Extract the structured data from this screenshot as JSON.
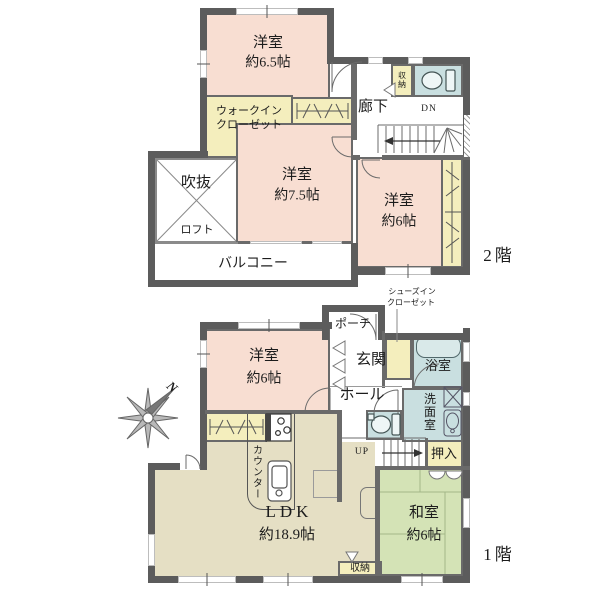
{
  "title": "2階建て住宅間取り図",
  "f2": {
    "floor_label": "2階",
    "room65": {
      "name": "洋室",
      "area": "約6.5帖"
    },
    "wic": {
      "line1": "ウォークイン",
      "line2": "クローゼット"
    },
    "corridor": "廊下",
    "down": "DN",
    "storage": "収納",
    "void": "吹抜",
    "loft": "ロフト",
    "room75": {
      "name": "洋室",
      "area": "約7.5帖"
    },
    "room6": {
      "name": "洋室",
      "area": "約6帖"
    },
    "balcony": "バルコニー"
  },
  "f1": {
    "floor_label": "1階",
    "porch": "ポーチ",
    "sic": {
      "line1": "シューズイン",
      "line2": "クローゼット"
    },
    "entrance": "玄関",
    "hall": "ホール",
    "bath": "浴室",
    "washroom": "洗面室",
    "up": "UP",
    "oshiire": "押入",
    "washitsu": {
      "name": "和室",
      "area": "約6帖"
    },
    "storage": "収納",
    "ldk": {
      "name": "LDK",
      "area": "約18.9帖"
    },
    "counter": "カウンター",
    "room6": {
      "name": "洋室",
      "area": "約6帖"
    }
  },
  "compass": {
    "north": "N"
  },
  "colors": {
    "wall": "#5c5c5c",
    "western_room": "#f8ded2",
    "closet": "#f4eebd",
    "wet_area": "#c9dfe0",
    "tatami": "#d4e3b6",
    "ldk": "#e5dfc4"
  }
}
